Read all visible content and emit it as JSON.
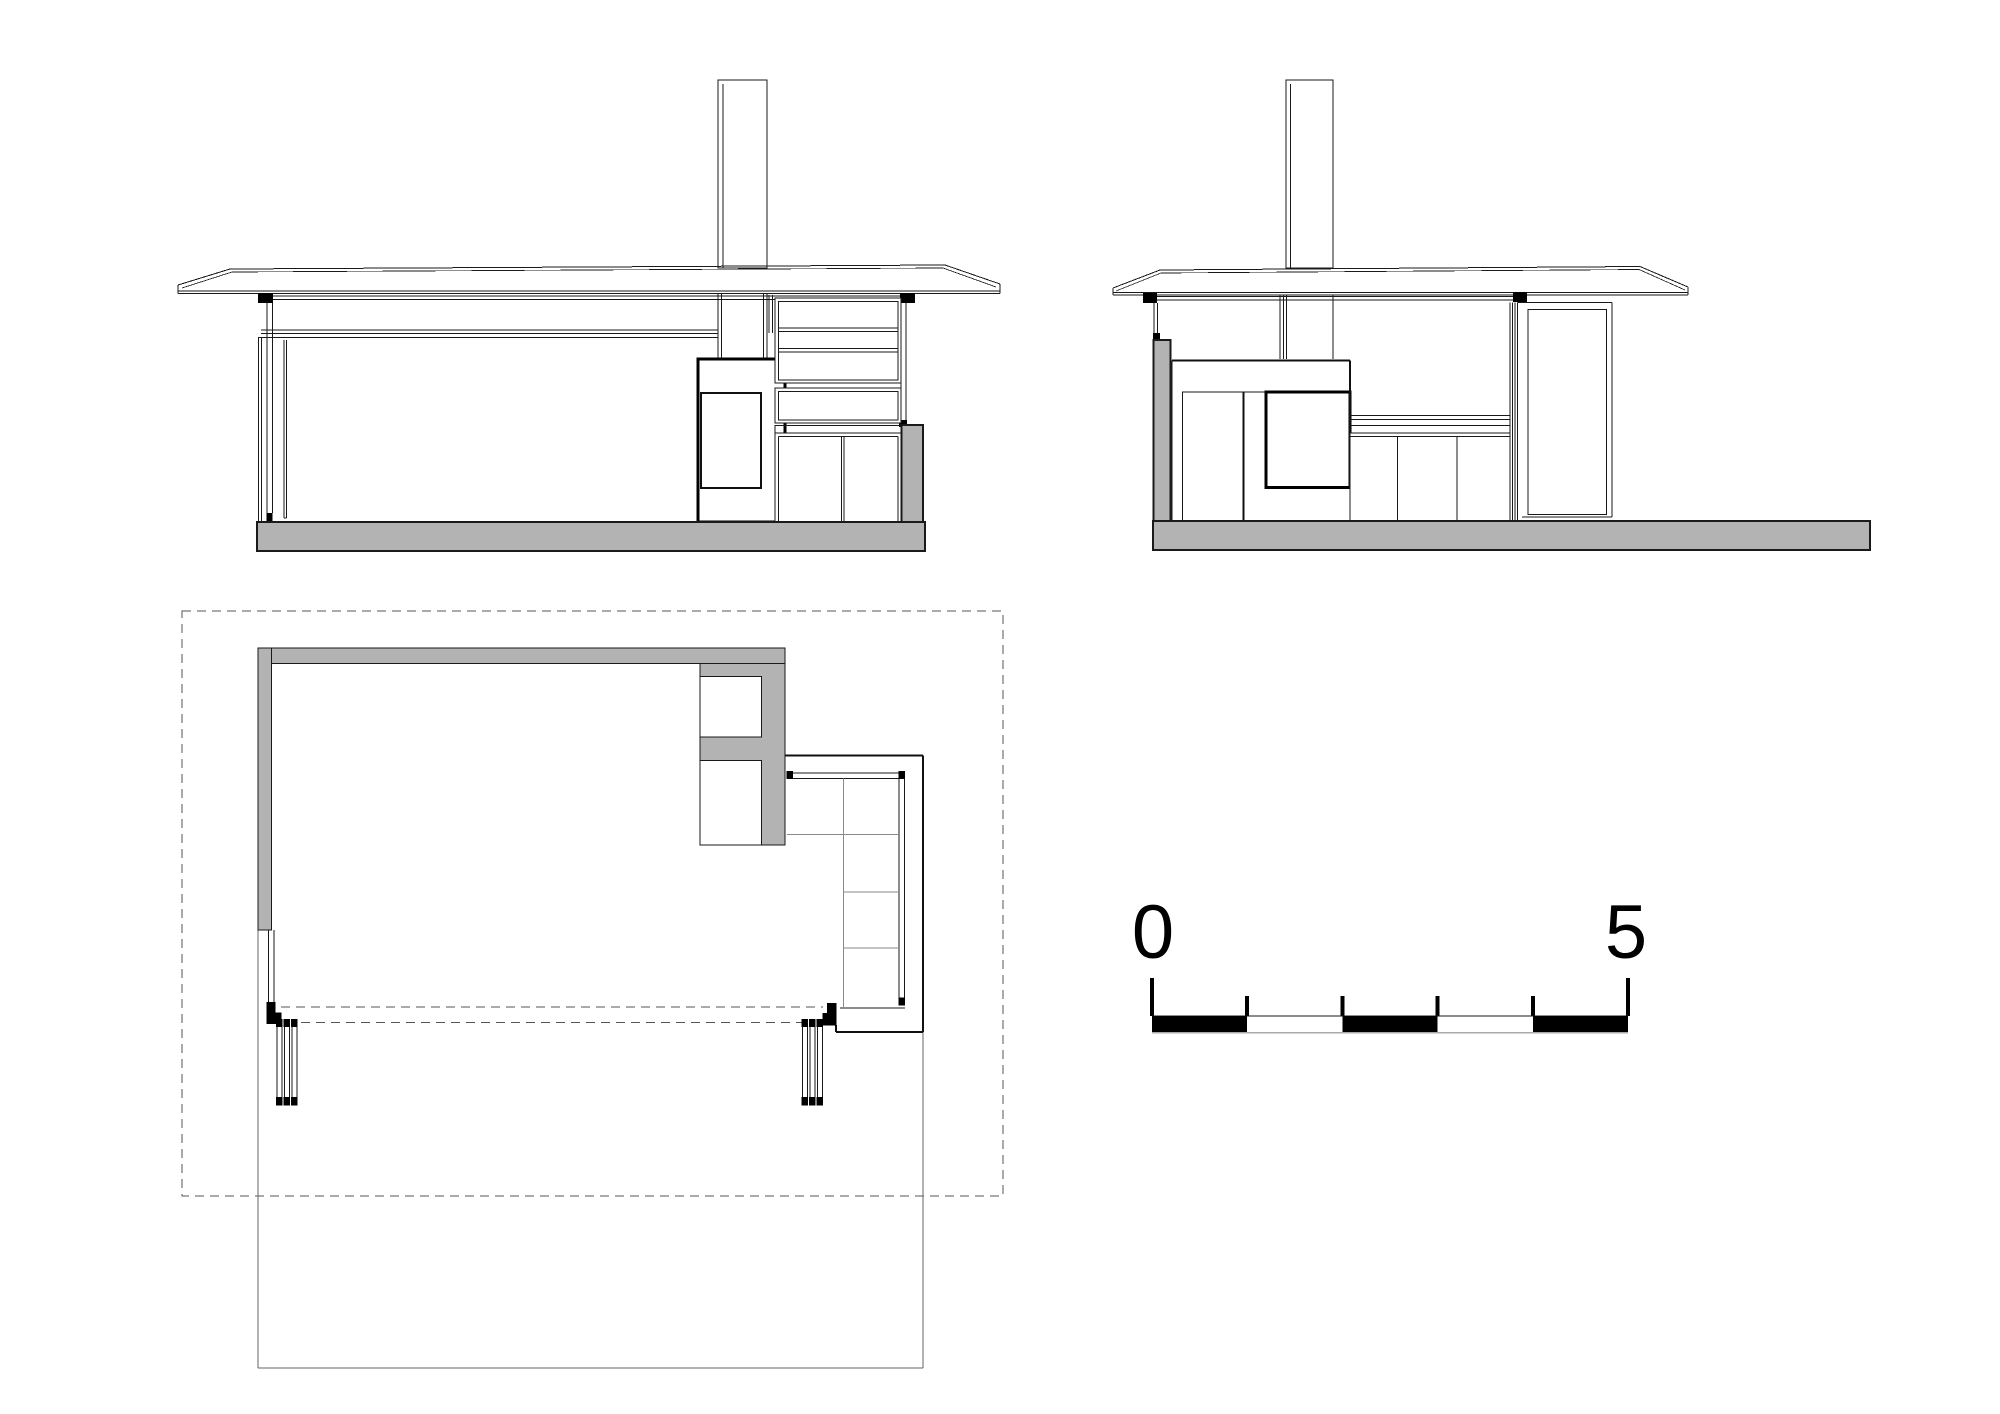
{
  "page": {
    "background": "#ffffff",
    "width": 2000,
    "height": 1414
  },
  "drawing": {
    "type": "architectural-orthographic-set",
    "views": [
      {
        "id": "section-long",
        "label": "long section / elevation with chimney, fireplace, shelving and cabinet"
      },
      {
        "id": "section-end",
        "label": "end section / elevation with chimney, fireplace mass and glazed door"
      },
      {
        "id": "floor-plan",
        "label": "floor plan with dashed roof outline, L-shaped wall, fireplace, built-in bench and sliding glass doors"
      }
    ],
    "colors": {
      "line": "#1a1a1a",
      "concrete_fill": "#b3b3b3",
      "light_line": "#8a8a8a",
      "dashed_line": "#555555",
      "black_fill": "#000000",
      "background": "#ffffff"
    }
  },
  "scale_bar": {
    "start_label": "0",
    "end_label": "5",
    "units": "meters",
    "segments": 5,
    "filled_segments": [
      1,
      3,
      5
    ]
  }
}
